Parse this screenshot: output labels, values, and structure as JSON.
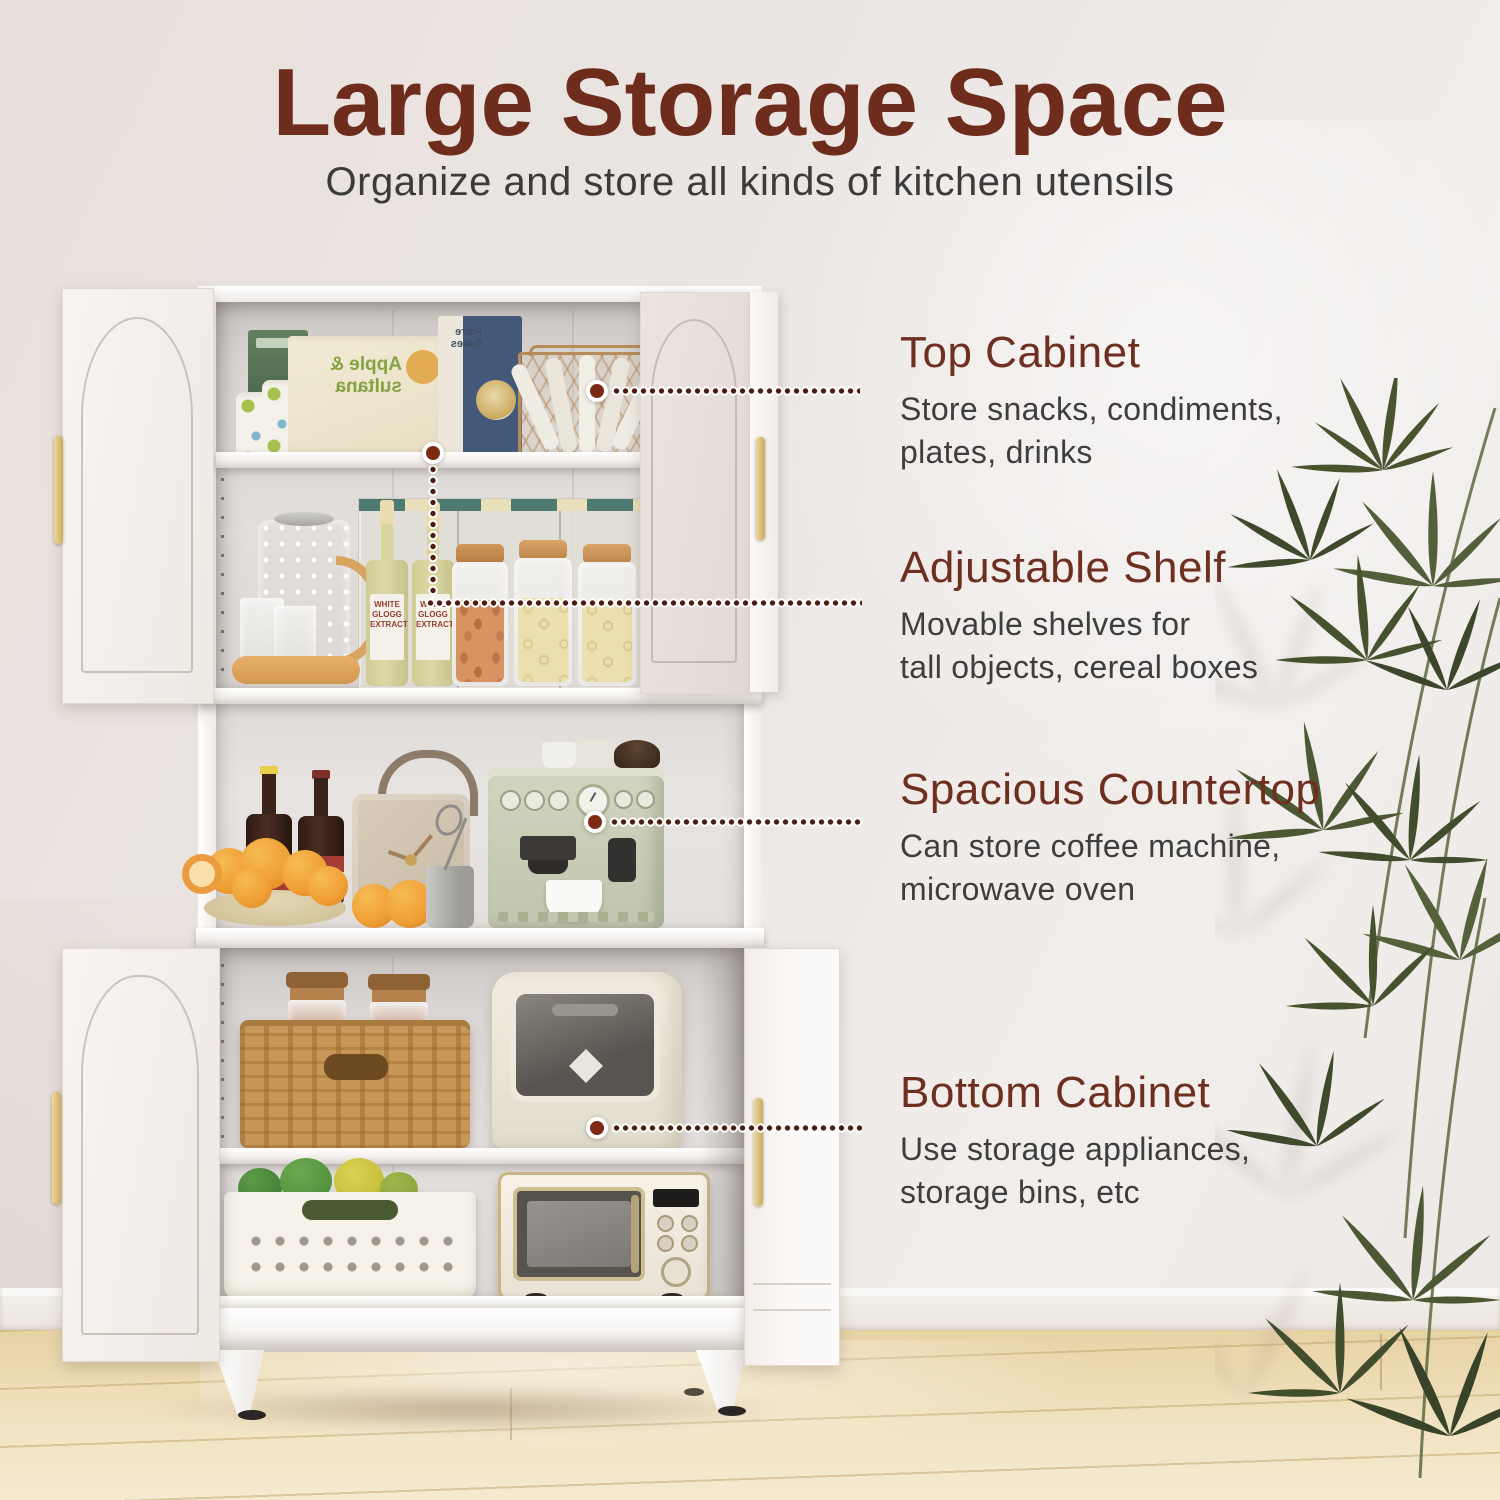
{
  "page": {
    "title": "Large Storage Space",
    "subtitle": "Organize and store all kinds of kitchen utensils"
  },
  "callouts": [
    {
      "title": "Top Cabinet",
      "lines": [
        "Store snacks, condiments,",
        "plates, drinks"
      ]
    },
    {
      "title": "Adjustable Shelf",
      "lines": [
        "Movable shelves for",
        "tall objects, cereal boxes"
      ]
    },
    {
      "title": "Spacious Countertop",
      "lines": [
        "Can store coffee machine,",
        "microwave oven"
      ]
    },
    {
      "title": "Bottom Cabinet",
      "lines": [
        "Use storage appliances,",
        "storage bins, etc"
      ]
    }
  ],
  "photo_items": {
    "cereal_box_front_label": "Apple & sultana",
    "cereal_box_back_label": "Fibre flakes",
    "bottle_label": "WHITE GLOGG EXTRACT"
  },
  "colors": {
    "accent_maroon": "#6e2c1e",
    "body_text": "#3f3e3e",
    "connector_dot": "#4b1d10",
    "handle_gold": "#d9c182",
    "cabinet_white": "#f7f4f1",
    "coffee_machine_sage": "#c7ccb6",
    "wall": "#ebe6e3",
    "floor_wood": "#ead7ab",
    "plant_green": "#4a5536"
  }
}
